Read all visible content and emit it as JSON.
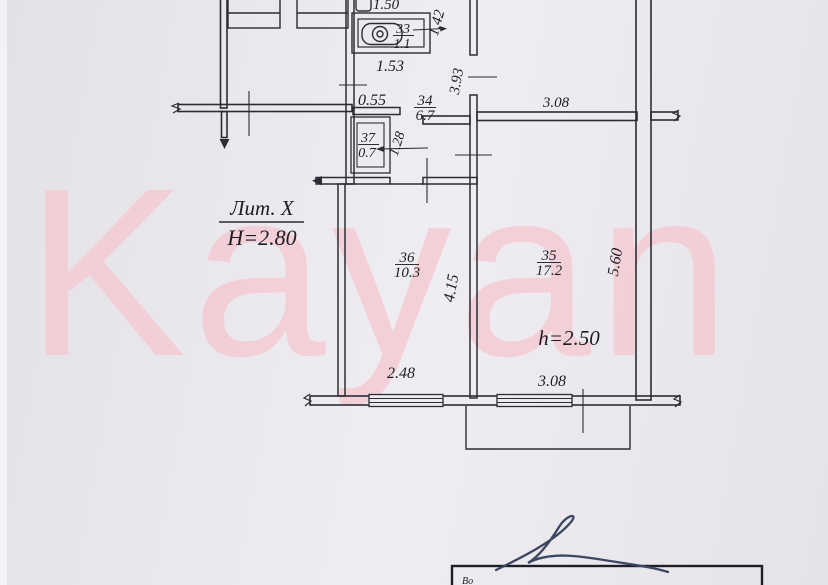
{
  "watermark": {
    "text": "Kayan",
    "color": "#f5cad2"
  },
  "plan": {
    "litera": "Лит. X",
    "building_height": "H=2.80",
    "ceiling_height": "h=2.50",
    "rooms": {
      "r33": {
        "number": "33",
        "area": "1.1"
      },
      "r34": {
        "number": "34",
        "area": "6.7"
      },
      "r35": {
        "number": "35",
        "area": "17.2"
      },
      "r36": {
        "number": "36",
        "area": "10.3"
      },
      "r37": {
        "number": "37",
        "area": "0.7"
      }
    },
    "dimensions": {
      "bath_width": "1.50",
      "bath_niche_depth": "1.42",
      "corridor_width": "1.53",
      "hall_step": "0.55",
      "hall_depth": "3.93",
      "upper_room_width": "3.08",
      "closet_depth": "1.28",
      "room36_width": "2.48",
      "room35_width": "3.08",
      "room36_depth": "4.15",
      "room35_depth": "5.60"
    }
  },
  "stamp": {
    "visible_text": "Во"
  },
  "colors": {
    "ink": "#2c2c34",
    "paper": "#eae8ed",
    "signature": "#3d4761"
  }
}
